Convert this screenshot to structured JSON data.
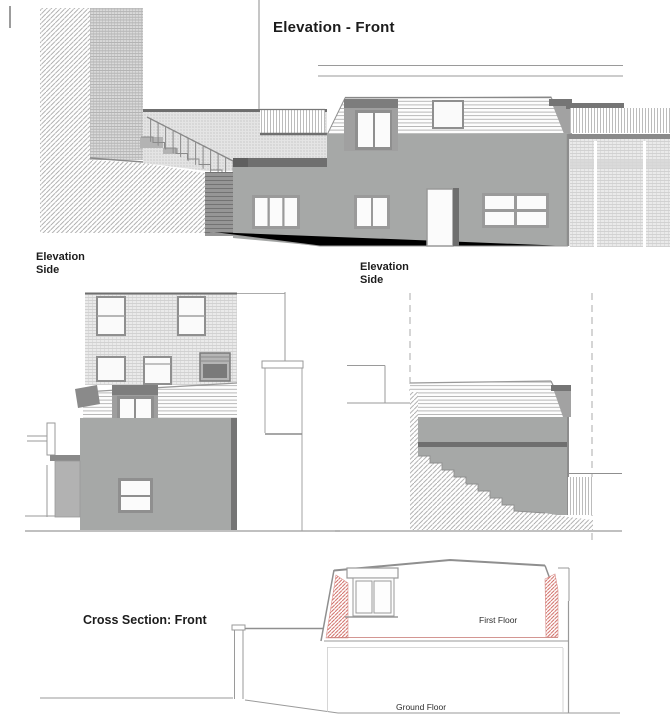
{
  "sheet": {
    "views": {
      "front_elevation": {
        "title": "Elevation - Front"
      },
      "side_elevation_left": {
        "title": "Elevation",
        "subtitle": "Side"
      },
      "side_elevation_right": {
        "title": "Elevation",
        "subtitle": "Side"
      },
      "cross_section": {
        "title": "Cross Section: Front",
        "first_floor_label": "First Floor",
        "ground_floor_label": "Ground Floor"
      }
    },
    "colors": {
      "wall_gray": "#a6a8a7",
      "dark_band_gray": "#6f6f6f",
      "frame_gray": "#8f8f8f",
      "line_gray": "#9a9a9a",
      "roof_white": "#fdfdfd",
      "red_hatch": "#cc5f58"
    }
  }
}
